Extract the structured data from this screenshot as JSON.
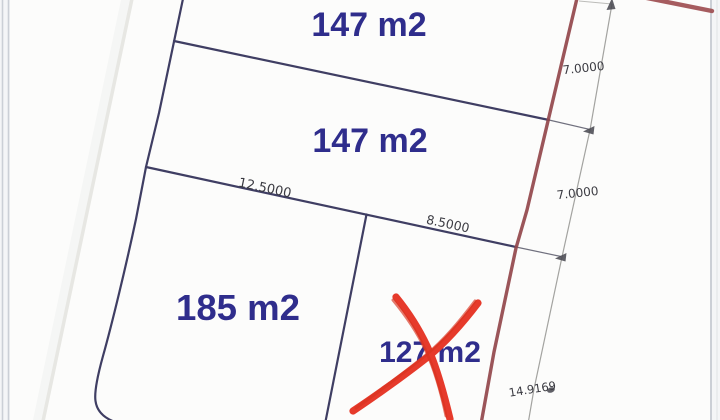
{
  "plan": {
    "parcels": [
      {
        "area": "147 m2"
      },
      {
        "area": "147 m2"
      },
      {
        "area": "185 m2"
      },
      {
        "area": "127 m2",
        "marked": "crossed-out"
      }
    ],
    "dimensions": {
      "upper_boundary": "12.5000",
      "lower_boundary": "8.5000",
      "east_top": "7.0000",
      "east_middle": "7.0000",
      "east_bottom": "14.9169"
    },
    "colors": {
      "area_label": "#2f2d8c",
      "boundary": "#3f3e63",
      "marked_boundary": "#92464b",
      "cross_mark": "#e63a2b",
      "dimension_text": "#3b3b42"
    }
  }
}
